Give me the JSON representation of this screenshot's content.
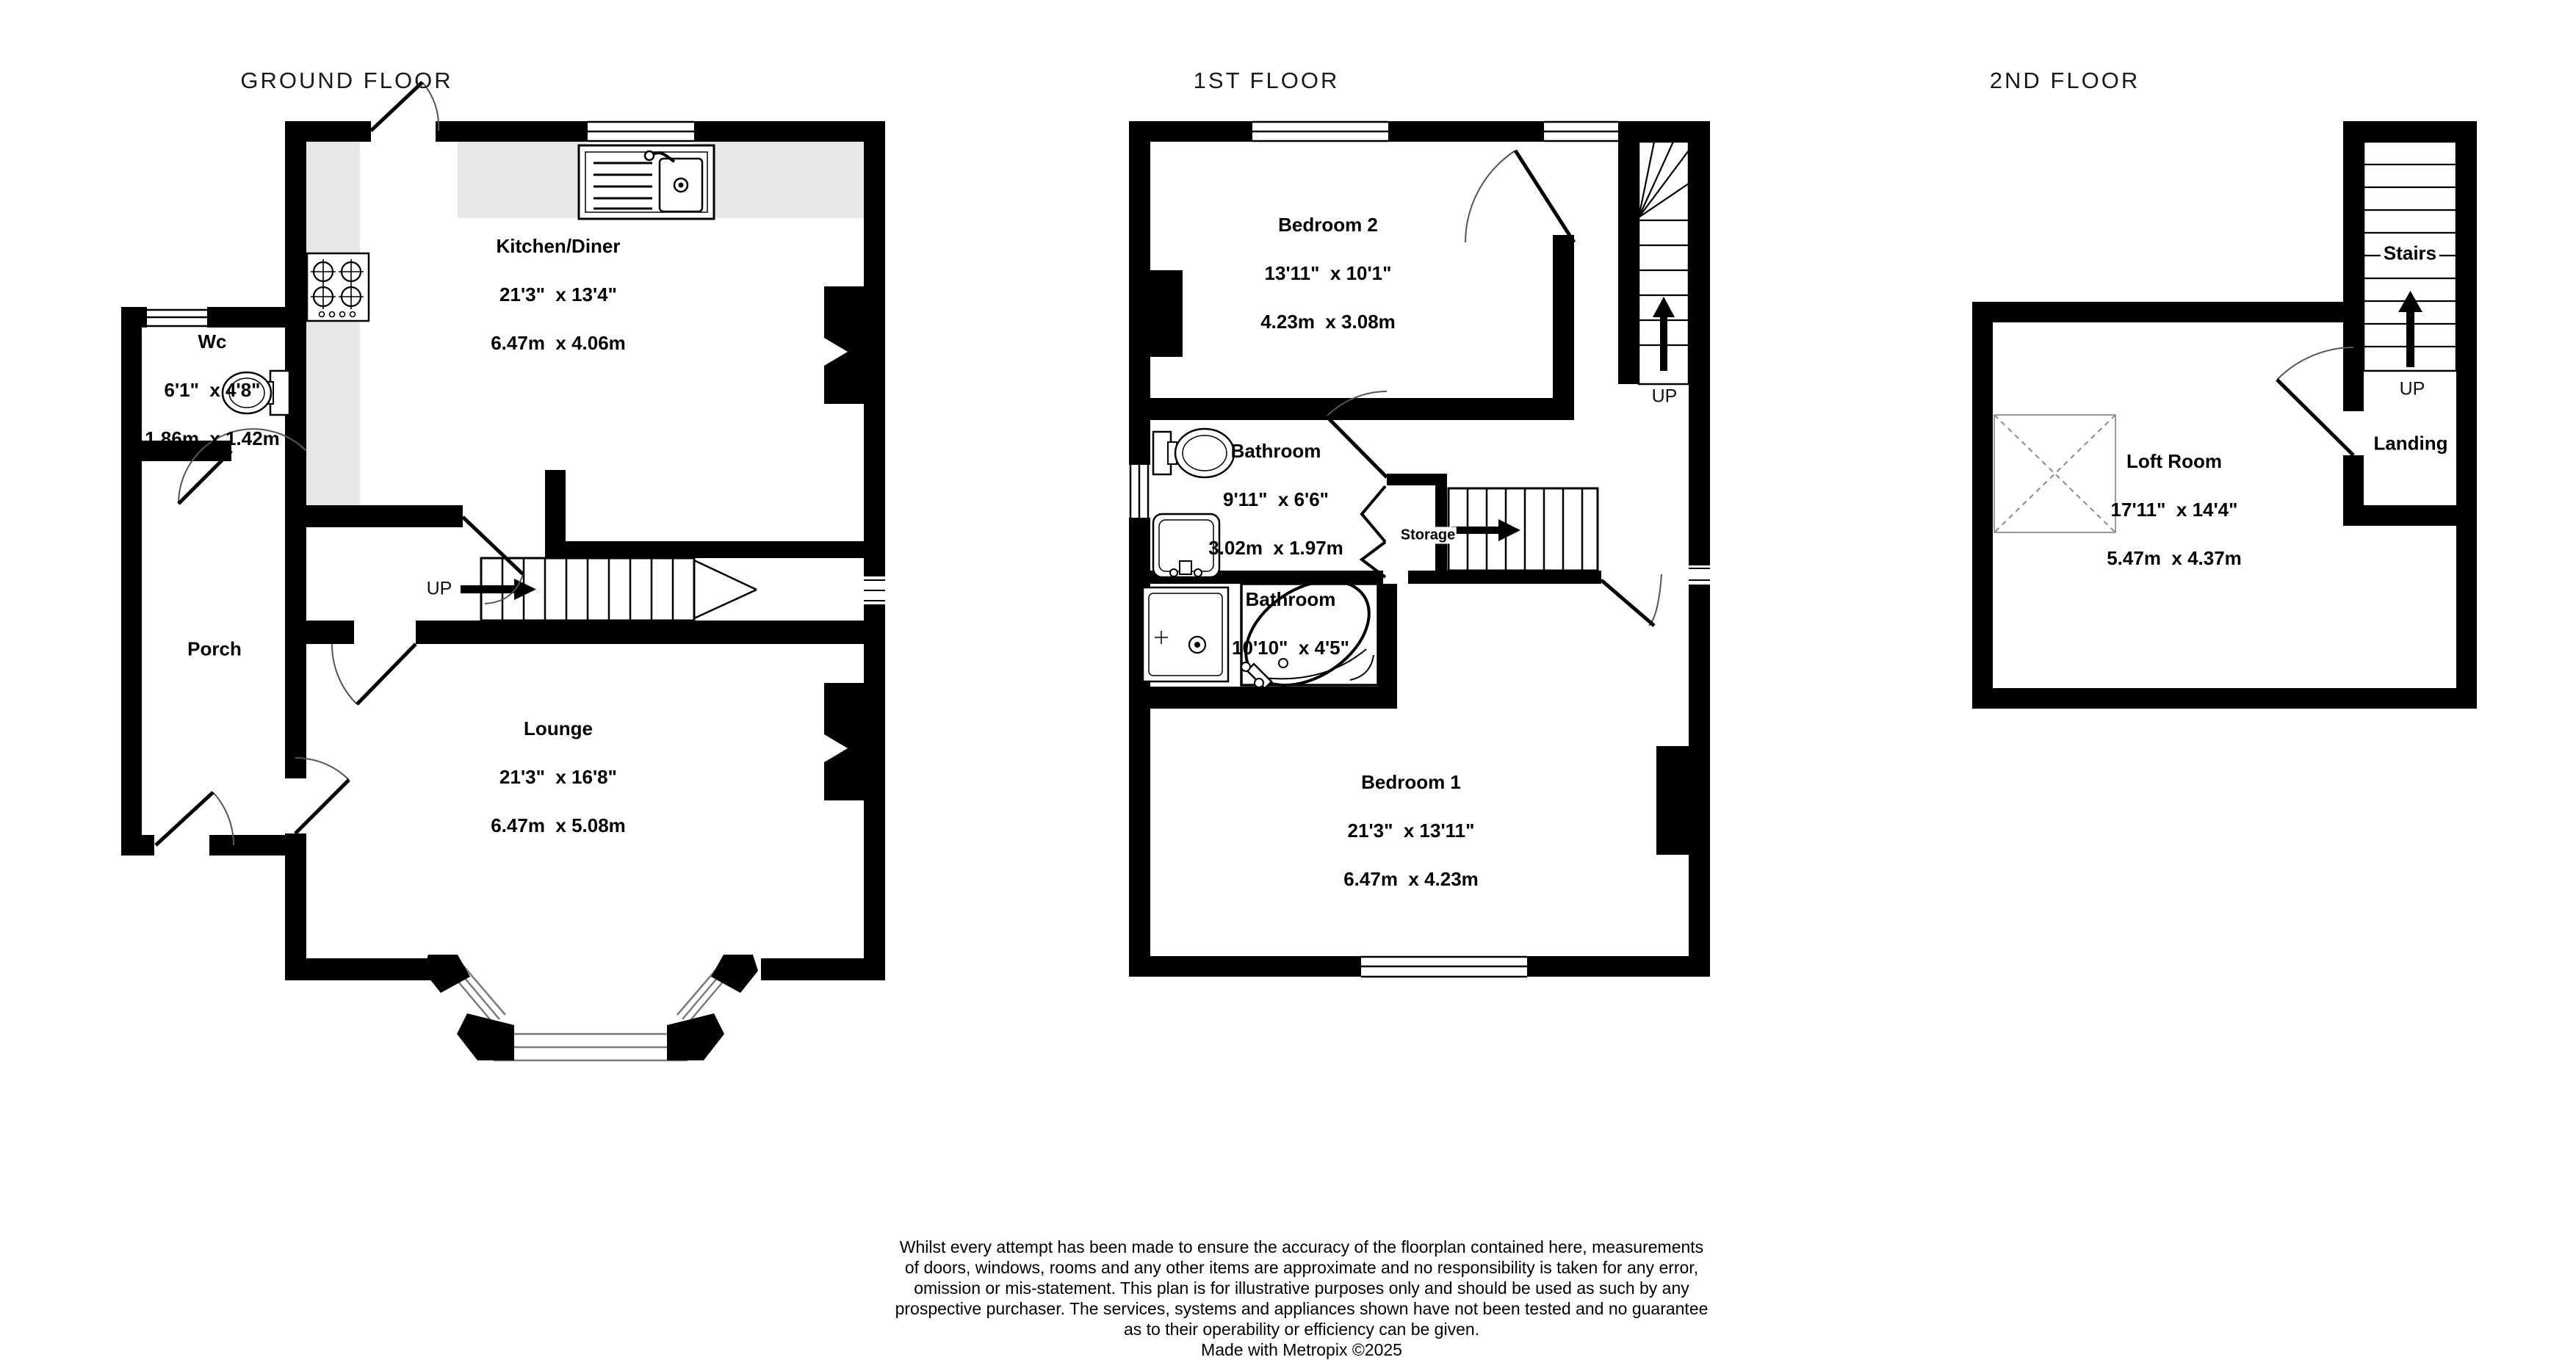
{
  "floors": [
    {
      "title": "GROUND FLOOR"
    },
    {
      "title": "1ST FLOOR"
    },
    {
      "title": "2ND FLOOR"
    }
  ],
  "rooms": {
    "kitchen": {
      "name": "Kitchen/Diner",
      "imperial": "21'3\"  x 13'4\"",
      "metric": "6.47m  x 4.06m"
    },
    "wc": {
      "name": "Wc",
      "imperial": "6'1\"  x 4'8\"",
      "metric": "1.86m  x 1.42m"
    },
    "hall": {
      "name": "Hall"
    },
    "porch": {
      "name": "Porch"
    },
    "lounge": {
      "name": "Lounge",
      "imperial": "21'3\"  x 16'8\"",
      "metric": "6.47m  x 5.08m"
    },
    "bedroom2": {
      "name": "Bedroom 2",
      "imperial": "13'11\"  x 10'1\"",
      "metric": "4.23m  x 3.08m"
    },
    "bathroom1": {
      "name": "Bathroom",
      "imperial": "9'11\"  x 6'6\"",
      "metric": "3.02m  x 1.97m"
    },
    "bathroom2": {
      "name": "Bathroom",
      "imperial": "10'10\"  x 4'5\"",
      "metric": "3.30m  x 1.35m"
    },
    "bedroom1": {
      "name": "Bedroom 1",
      "imperial": "21'3\"  x 13'11\"",
      "metric": "6.47m  x 4.23m"
    },
    "loft": {
      "name": "Loft Room",
      "imperial": "17'11\"  x 14'4\"",
      "metric": "5.47m  x 4.37m"
    },
    "landing": {
      "name": "Landing"
    },
    "stairs": {
      "name": "Stairs"
    },
    "storage": {
      "name": "Storage"
    }
  },
  "labels": {
    "up": "UP"
  },
  "disclaimer": {
    "lines": [
      "Whilst every attempt has been made to ensure the accuracy of the floorplan contained here, measurements",
      "of doors, windows, rooms and any other items are approximate and no responsibility is taken for any error,",
      "omission or mis-statement. This plan is for illustrative purposes only and should be used as such by any",
      "prospective purchaser. The services, systems and appliances shown have not been tested and no guarantee",
      "as to their operability or efficiency can be given.",
      "Made with Metropix ©2025"
    ]
  },
  "colors": {
    "wall": "#000000",
    "counter": "#e7e7e7",
    "window_line": "#7a7a7a"
  }
}
